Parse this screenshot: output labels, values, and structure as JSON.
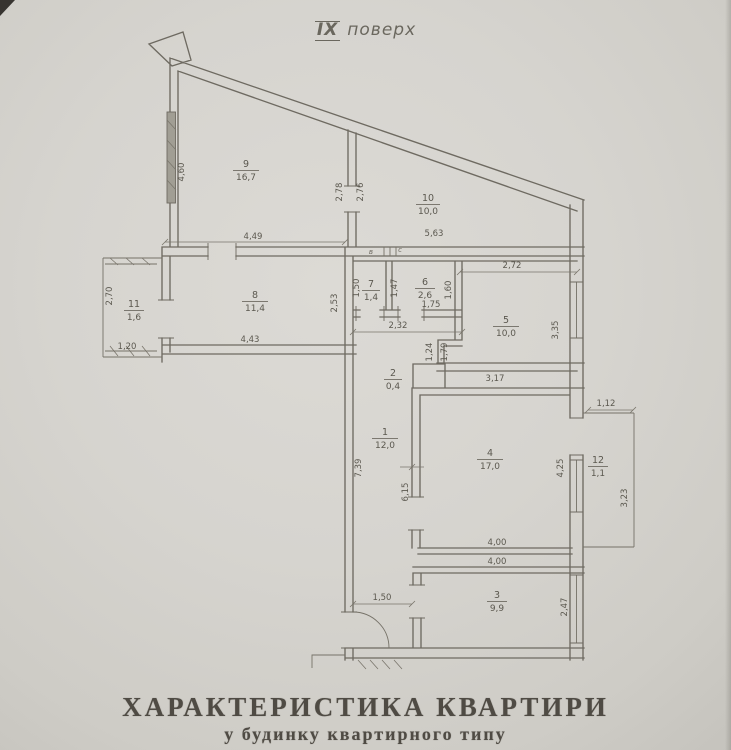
{
  "header": {
    "floor_numeral": "IX",
    "floor_word": "поверх"
  },
  "footer": {
    "title": "ХАРАКТЕРИСТИКА КВАРТИРИ",
    "subtitle": "у будинку квартирного типу"
  },
  "rooms": [
    {
      "number": "9",
      "area": "16,7"
    },
    {
      "number": "10",
      "area": "10,0"
    },
    {
      "number": "11",
      "area": "1,6"
    },
    {
      "number": "8",
      "area": "11,4"
    },
    {
      "number": "7",
      "area": "1,4"
    },
    {
      "number": "6",
      "area": "2,6"
    },
    {
      "number": "5",
      "area": "10,0"
    },
    {
      "number": "2",
      "area": "0,4"
    },
    {
      "number": "1",
      "area": "12,0"
    },
    {
      "number": "4",
      "area": "17,0"
    },
    {
      "number": "12",
      "area": "1,1"
    },
    {
      "number": "3",
      "area": "9,9"
    }
  ],
  "dims": {
    "room9_left": "4,60",
    "room9_bottom": "4,49",
    "mid_left": "2,78",
    "mid_right": "2,76",
    "room10_bottom": "5,63",
    "room11_left": "2,70",
    "room11_bottom": "1,20",
    "room8_bottom": "4,43",
    "room8_right": "2,53",
    "room7_left": "1,50",
    "room6_left": "1,47",
    "room6_bottom": "1,75",
    "room6_right": "1,60",
    "sanitary_bottom": "2,32",
    "room5_top": "2,72",
    "room5_right": "3,35",
    "room5_bottom": "3,17",
    "jog_upper": "1,24",
    "jog_lower": "1,79",
    "hall_left": "7,39",
    "hall_right": "6,15",
    "room4_right": "4,25",
    "room4_bottom": "4,00",
    "room3_top": "4,00",
    "room3_right": "2,47",
    "balcony_top": "1,12",
    "balcony_right": "3,23",
    "entry_width": "1,50"
  },
  "annotations": {
    "vent_a": "в",
    "vent_b": "с"
  },
  "colors": {
    "paper": "#d6d4cf",
    "ink": "#6e6a61",
    "text": "#5b584f",
    "title_text": "#4f4b44"
  }
}
